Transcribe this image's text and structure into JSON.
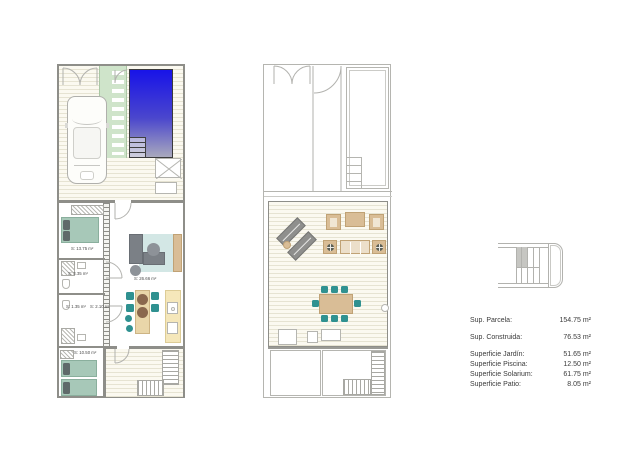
{
  "area_table": {
    "rows": [
      {
        "label": "Sup. Parcela:",
        "value": "154.75 m²"
      },
      {
        "label": "Sup. Construida:",
        "value": "76.53 m²"
      },
      {
        "label": "Superficie Jardín:",
        "value": "51.65 m²"
      },
      {
        "label": "Superficie Piscina:",
        "value": "12.50 m²"
      },
      {
        "label": "Superficie Solarium:",
        "value": "61.75 m²"
      },
      {
        "label": "Superficie Patio:",
        "value": "8.05 m²"
      }
    ]
  },
  "plans": {
    "ground_floor": {
      "room_labels": [
        {
          "room": "bedroom-1",
          "text": "S: 13.75 m²"
        },
        {
          "room": "bathroom-1",
          "text": "S: 3.35 m²"
        },
        {
          "room": "bathroom-2",
          "text": "S: 1.35 m²"
        },
        {
          "room": "hall",
          "text": "S: 2.10 m²"
        },
        {
          "room": "living-room",
          "text": "S: 26.66 m²"
        },
        {
          "room": "bedroom-2",
          "text": "S: 10.50 m²"
        }
      ]
    },
    "first_floor": {
      "room_labels": []
    }
  },
  "colors": {
    "pool_top": "#1813e8",
    "pool_bottom": "#a9a9bd",
    "garden": "#cfe4ca",
    "deck": "#fbf9f0",
    "deck_line": "#e6e3d2",
    "wall": "#8e8e89",
    "bed": "#a7c8b8",
    "rug": "#d3e7e5",
    "sofa": "#7b8086",
    "chair": "#2f9190",
    "tan": "#d9bd96",
    "counter": "#f5e7ba"
  }
}
